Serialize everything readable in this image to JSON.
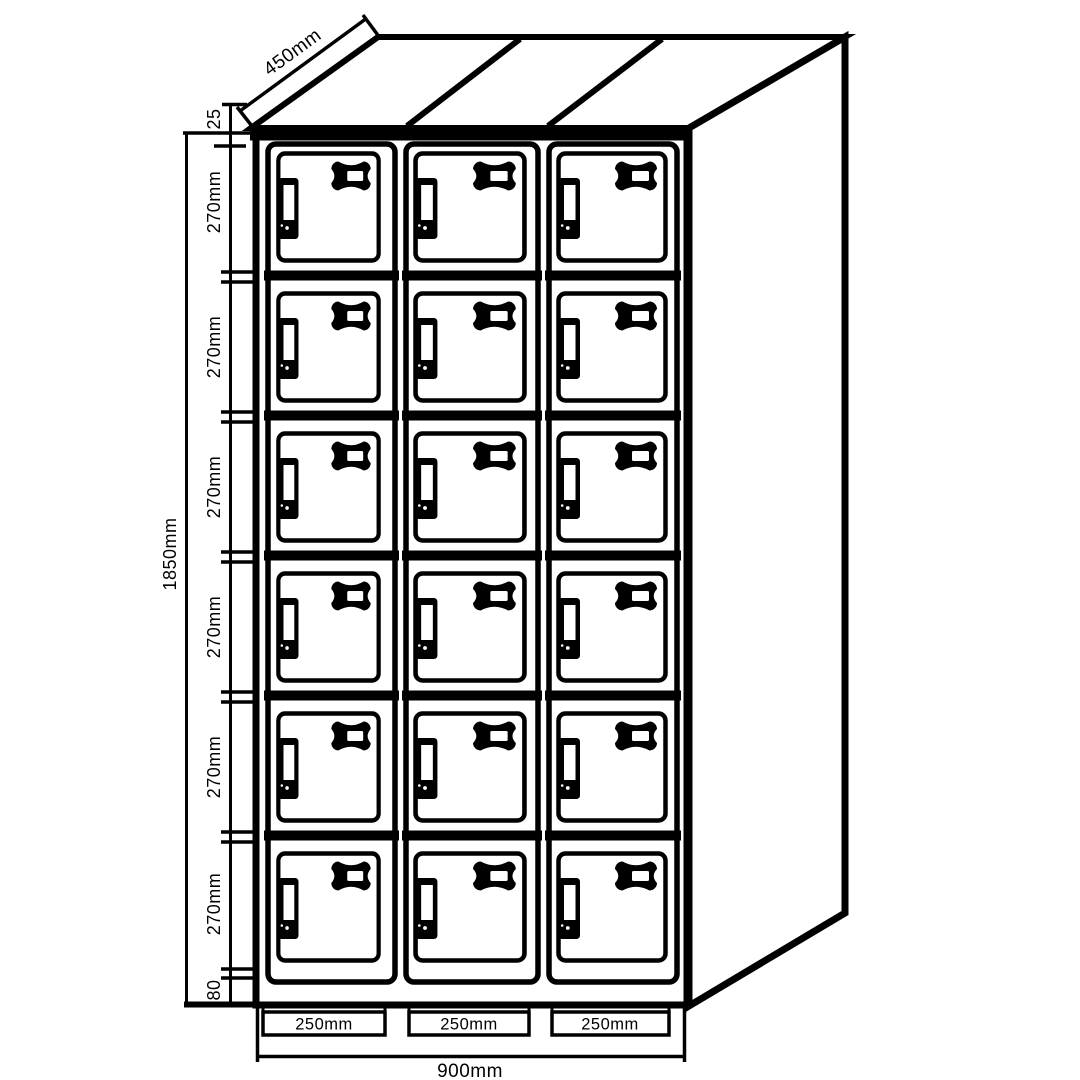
{
  "title": "Locker cabinet dimensioned technical drawing",
  "structure": {
    "columns": 3,
    "rows": 6,
    "compartments": 18
  },
  "dimensions": {
    "depth": "450mm",
    "top_frame": "25",
    "compartment_heights": [
      "270mm",
      "270mm",
      "270mm",
      "270mm",
      "270mm",
      "270mm"
    ],
    "plinth": "80",
    "total_height": "1850mm",
    "column_widths": [
      "250mm",
      "250mm",
      "250mm"
    ],
    "total_width": "900mm"
  },
  "colors": {
    "line": "#000000",
    "background": "#ffffff"
  }
}
